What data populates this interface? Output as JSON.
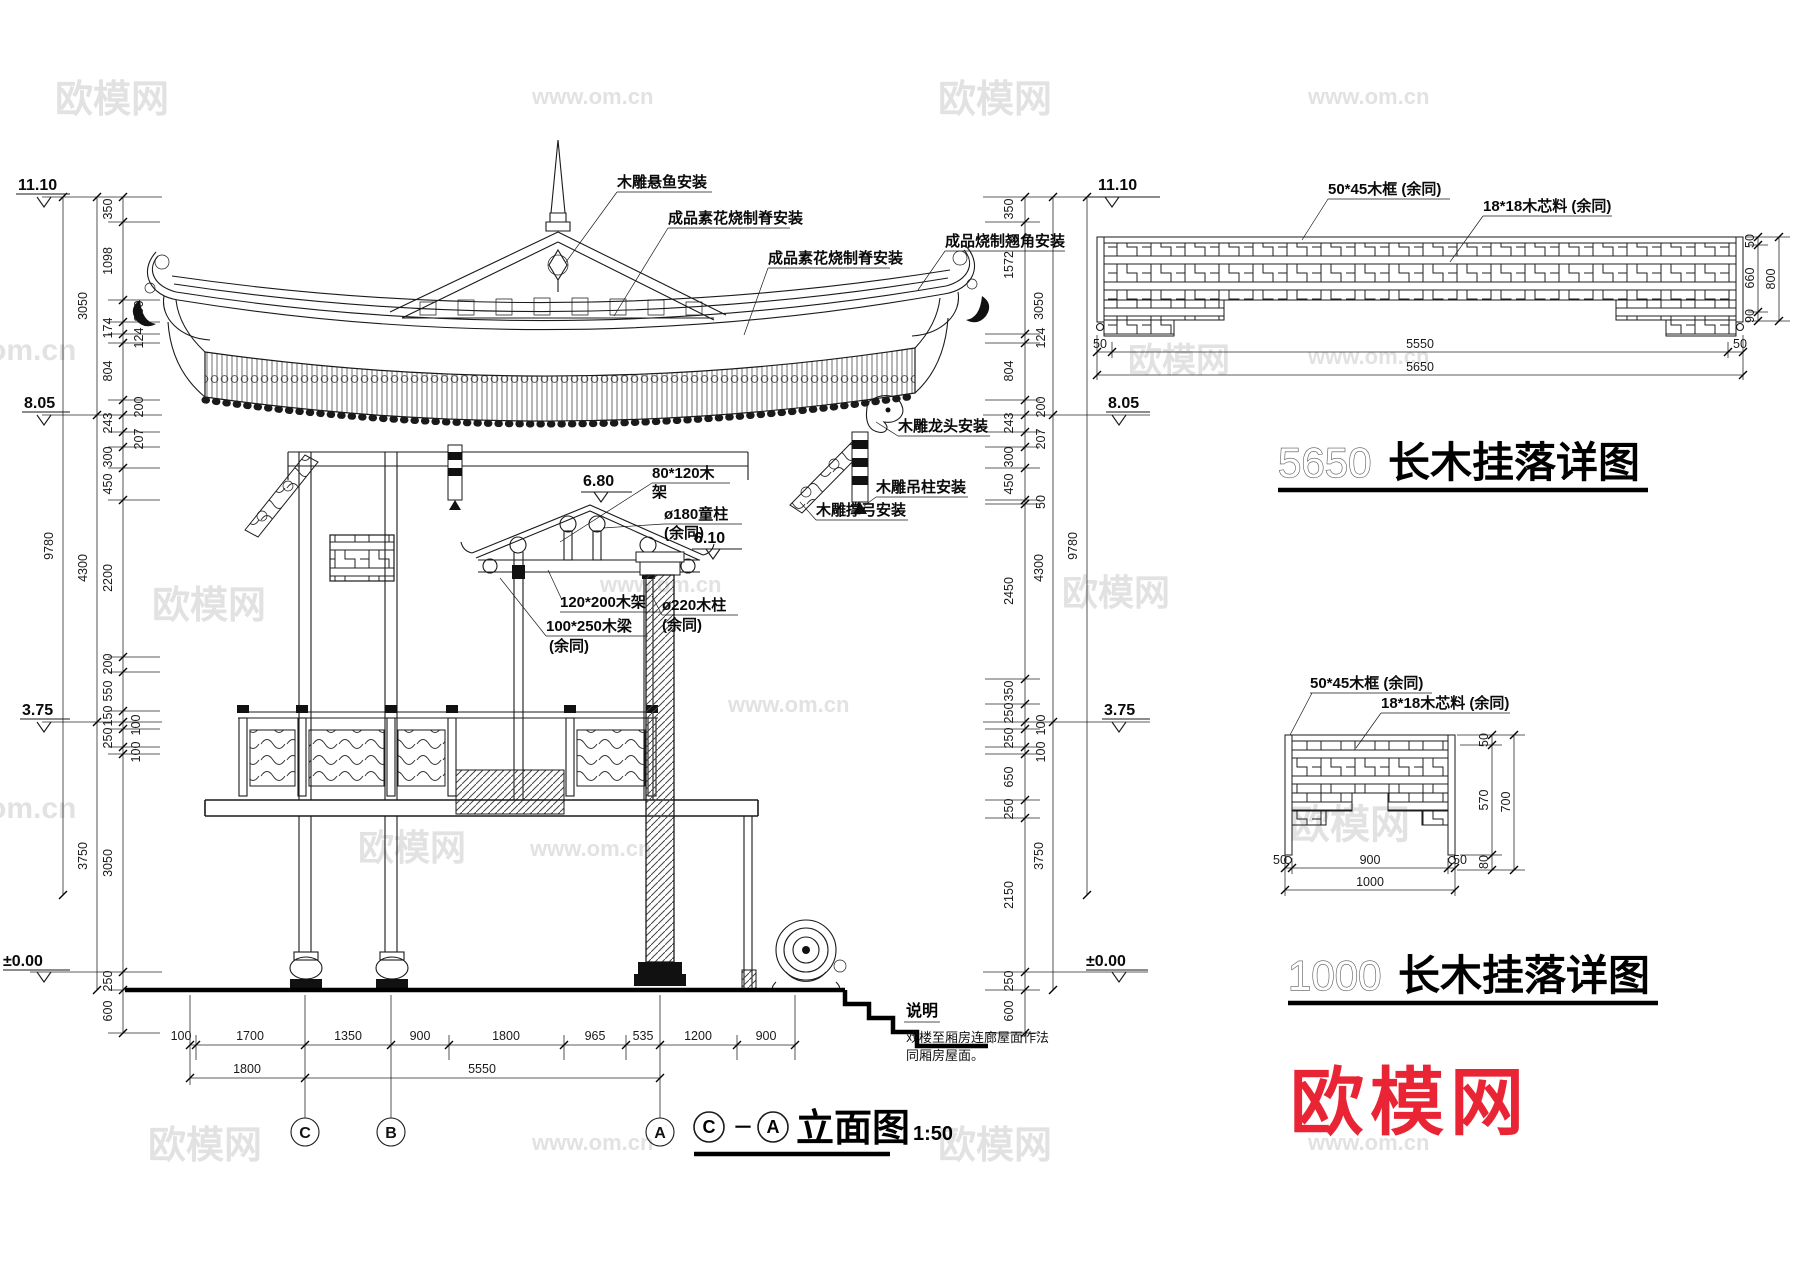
{
  "brand": {
    "name": "欧模网",
    "site": "www.om.cn",
    "site_short": "om.cn",
    "logo_color": "#e60012"
  },
  "main_view": {
    "levels": {
      "top": "11.10",
      "eave": "8.05",
      "floor": "3.75",
      "ground": "±0.00",
      "inner_ridge": "6.80",
      "inner_eave": "6.10"
    },
    "annotations": {
      "xuanyu": "木雕悬鱼安装",
      "ridge_left": "成品素花烧制脊安装",
      "ridge_right": "成品素花烧制脊安装",
      "corner": "成品烧制翘角安装",
      "dragon_head": "木雕龙头安装",
      "hang_post": "木雕吊柱安装",
      "bracket_bow": "木雕撑弓安装",
      "frame_80": {
        "line1": "80*120木",
        "line2": "架"
      },
      "tong_column": {
        "line1": "ø180童柱",
        "line2": "(余同)"
      },
      "frame_120": "120*200木架",
      "beam_100": {
        "line1": "100*250木梁",
        "line2": "(余同)"
      },
      "column_220": {
        "line1": "ø220木柱",
        "line2": "(余同)"
      }
    },
    "grid": {
      "c": "C",
      "b": "B",
      "a": "A"
    },
    "dims": {
      "left_outer": [
        "9780"
      ],
      "left_mid": [
        "3050",
        "4300",
        "3750"
      ],
      "left_inner": [
        "350",
        "1098",
        "300",
        "174",
        "124",
        "804",
        "200",
        "243",
        "207",
        "300",
        "450",
        "2200",
        "200",
        "550",
        "150",
        "100",
        "250",
        "100",
        "3050",
        "250",
        "600"
      ],
      "right_outer": [
        "9780"
      ],
      "right_mid": [
        "3050",
        "4300",
        "3750"
      ],
      "right_inner": [
        "350",
        "1572",
        "124",
        "804",
        "200",
        "243",
        "207",
        "300",
        "450",
        "50",
        "2450",
        "350",
        "250",
        "100",
        "250",
        "100",
        "650",
        "250",
        "2150",
        "250",
        "600"
      ],
      "bottom_row1": [
        "100",
        "1700",
        "1350",
        "900",
        "1800",
        "965",
        "535",
        "1200",
        "900"
      ],
      "bottom_row2": [
        "1800",
        "5550"
      ]
    },
    "title": {
      "from": "C",
      "sep": "－",
      "to": "A",
      "label": "立面图",
      "scale": "1:50"
    },
    "notes": {
      "label": "说明",
      "line1": "戏楼至厢房连廊屋面作法",
      "line2": "同厢房屋面。"
    }
  },
  "detail_5650": {
    "level": "11.10",
    "ann_frame": "50*45木框 (余同)",
    "ann_core": "18*18木芯料 (余同)",
    "dims_bottom": [
      "50",
      "5550",
      "50"
    ],
    "dim_total": "5650",
    "dims_right": [
      "50",
      "660",
      "90"
    ],
    "dim_right_total": "800",
    "title_num": "5650",
    "title_text": "长木挂落详图"
  },
  "detail_1000": {
    "ann_frame": "50*45木框 (余同)",
    "ann_core": "18*18木芯料 (余同)",
    "dims_bottom": [
      "50",
      "900",
      "50"
    ],
    "dim_total": "1000",
    "dims_right": [
      "50",
      "570",
      "80"
    ],
    "dim_right_total": "700",
    "title_num": "1000",
    "title_text": "长木挂落详图"
  }
}
